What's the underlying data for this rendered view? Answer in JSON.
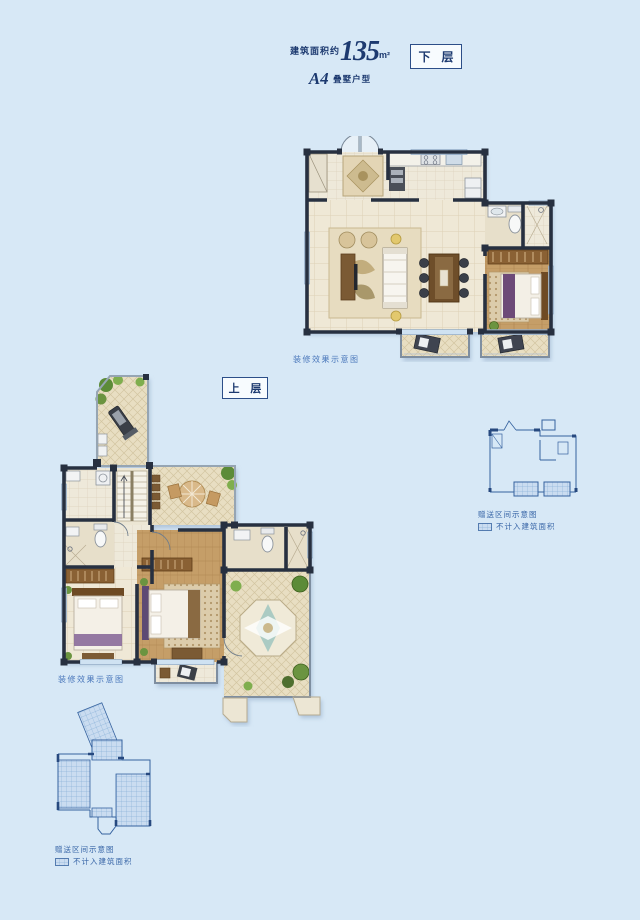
{
  "header": {
    "area_label": "建筑面积约",
    "area_value": "135",
    "area_unit": "m²",
    "unit_code": "A4",
    "unit_type": "叠墅户型"
  },
  "floors": {
    "lower": {
      "tag": "下 层",
      "caption": "装修效果示意图"
    },
    "upper": {
      "tag": "上 层",
      "caption": "装修效果示意图"
    }
  },
  "keyplans": {
    "note": "赠送区间示意图",
    "legend": "不计入建筑面积"
  },
  "colors": {
    "bg": "#d7e8f6",
    "navy": "#1d3a70",
    "wall": "#273040",
    "blueprint": "#3a67a8",
    "caption": "#4a77bb",
    "beige": "#efe8d6",
    "tan": "#e9dfc4",
    "wood": "#c59e68",
    "accent_green": "#6b9440",
    "accent_yellow": "#e2c86e",
    "accent_purple": "#6d4a78"
  }
}
